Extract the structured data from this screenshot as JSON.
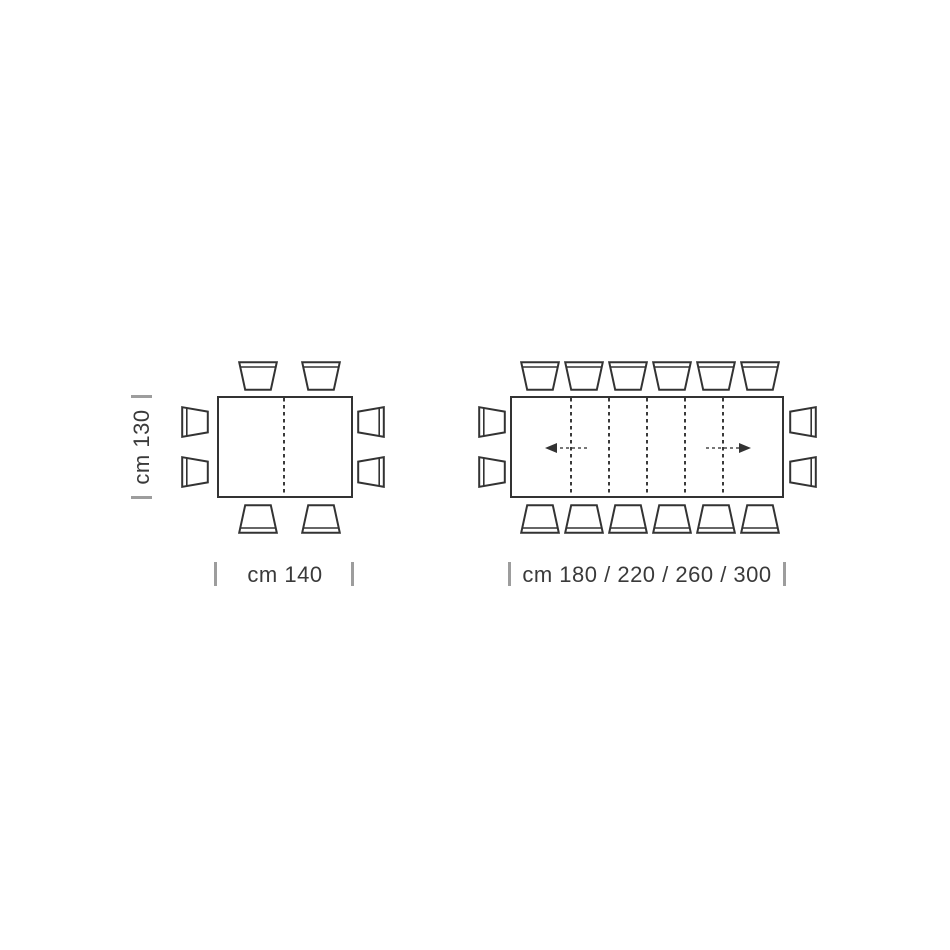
{
  "page": {
    "title": "Extending dining table dimension diagram (top view)",
    "background": "#ffffff"
  },
  "colors": {
    "line": "#333333",
    "tick": "#9d9d9d",
    "text": "#3a3a3a",
    "background": "#ffffff"
  },
  "fixed_table": {
    "width_label": "cm 140",
    "depth_label": "cm 130",
    "width_cm": 140,
    "depth_cm": 130,
    "leaf_lines": 1,
    "seats": {
      "top": 2,
      "bottom": 2,
      "left": 2,
      "right": 2,
      "total": 8
    }
  },
  "extending_table": {
    "width_label": "cm 180 / 220 / 260 / 300",
    "extension_lengths_cm": [
      180,
      220,
      260,
      300
    ],
    "leaf_lines": 5,
    "extension_arrows": [
      "left",
      "right"
    ],
    "seats": {
      "top": 6,
      "bottom": 6,
      "left": 2,
      "right": 2,
      "total": 16
    }
  }
}
